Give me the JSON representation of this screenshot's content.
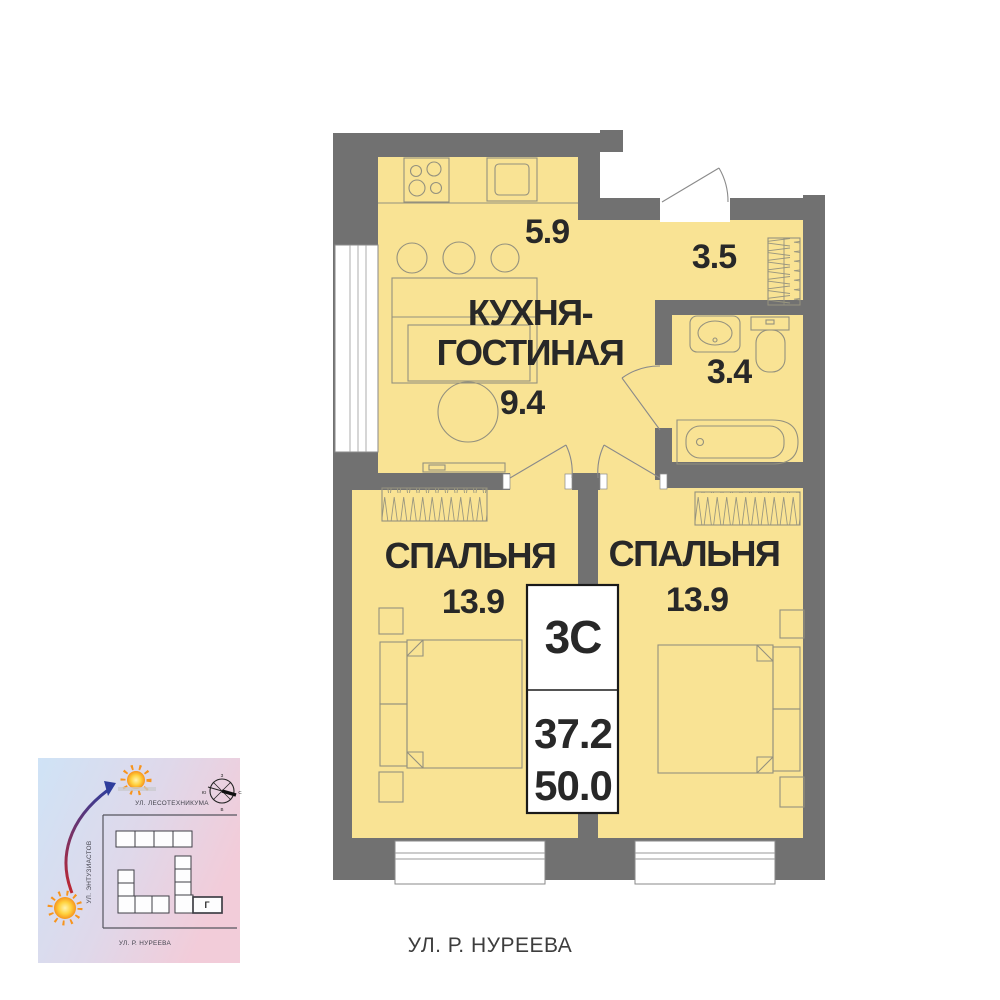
{
  "colors": {
    "wall_gray": "#717171",
    "floor_yellow": "#F9E394",
    "furniture_stroke": "#94917e",
    "text_dark": "#282828",
    "map_blue": "#cfe3f6",
    "map_pink": "#f2ccd9",
    "arrow_red": "#c2272f",
    "arrow_blue": "#2e3d9c",
    "sun_orange": "#f7941d"
  },
  "plan": {
    "kitchen_living": {
      "label_line1": "КУХНЯ-",
      "label_line2": "ГОСТИНАЯ",
      "kitchen_area": "5.9",
      "living_area": "9.4"
    },
    "hallway": {
      "area": "3.5"
    },
    "bathroom": {
      "area": "3.4"
    },
    "bedroom_left": {
      "label": "СПАЛЬНЯ",
      "area": "13.9"
    },
    "bedroom_right": {
      "label": "СПАЛЬНЯ",
      "area": "13.9"
    },
    "info_box": {
      "type": "3С",
      "living_area_total": "37.2",
      "total_area": "50.0"
    },
    "street_label": "УЛ. Р. НУРЕЕВА"
  },
  "minimap": {
    "street_top": "УЛ. ЛЕСОТЕХНИКУМА",
    "street_left": "УЛ. ЭНТУЗИАСТОВ",
    "street_bottom": "УЛ. Р. НУРЕЕВА",
    "building_label": "Г",
    "compass": {
      "n": "С",
      "s": "Ю",
      "e": "В",
      "w": "З"
    }
  }
}
